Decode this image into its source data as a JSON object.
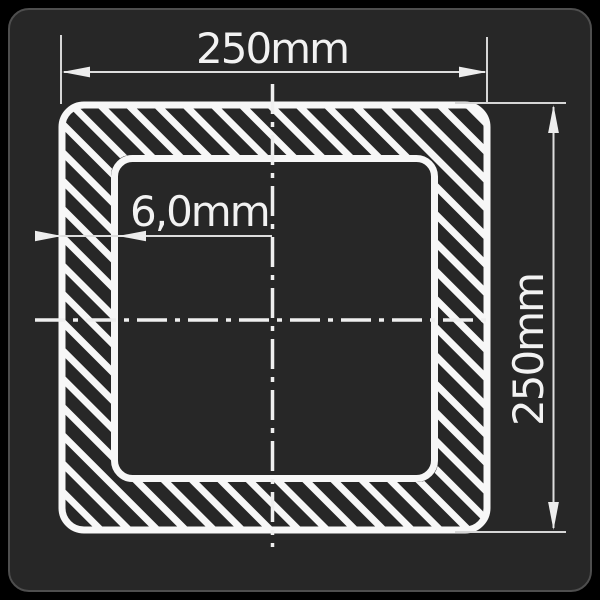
{
  "title": "Square hollow section cross-section drawing",
  "drawing": {
    "type": "square-tube-cross-section",
    "hatch": "diagonal-45deg-white-stripes"
  },
  "colors": {
    "canvas_bg": "#000000",
    "panel_bg": "#272727",
    "panel_border": "#4e4e4e",
    "tube_line": "#f7f7f7",
    "dimension_line": "#dedede",
    "centerline": "#efefef",
    "text": "#f2f2f2"
  },
  "dimensions": {
    "width": {
      "label": "250mm"
    },
    "height": {
      "label": "250mm"
    },
    "wall_thickness": {
      "label": "6,0mm"
    }
  }
}
